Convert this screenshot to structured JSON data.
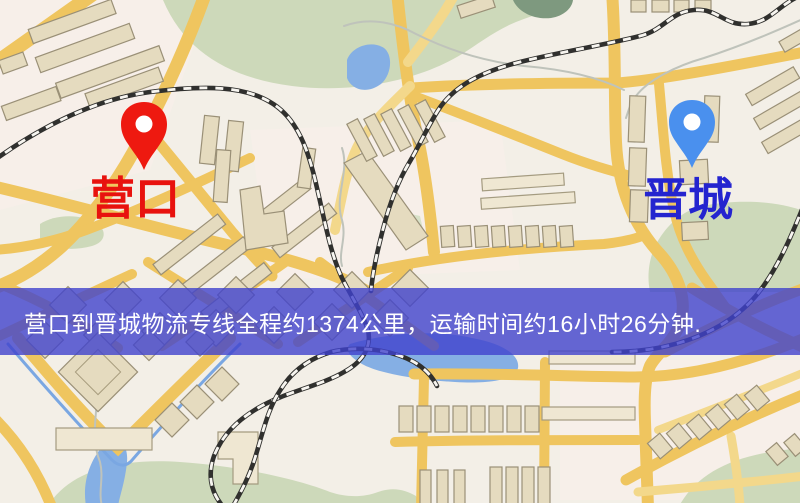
{
  "page": {
    "type": "logistics-route-map-image",
    "width_px": 800,
    "height_px": 503
  },
  "banner": {
    "text": "营口到晋城物流专线全程约1374公里，运输时间约16小时26分钟.",
    "text_color": "#ffffff",
    "background_color": "#4042cd",
    "route": {
      "origin": "营口",
      "destination": "晋城",
      "service": "物流专线",
      "distance_text": "约1374公里",
      "duration_text": "约16小时26分钟"
    }
  },
  "markers": {
    "origin": {
      "label": "营口",
      "label_color": "#e8120e",
      "pin_color": "#ee1910",
      "pin_icon": "red-map-pin-icon"
    },
    "destination": {
      "label": "晋城",
      "label_color": "#2424cf",
      "pin_color": "#4a90ee",
      "pin_icon": "blue-map-pin-icon"
    }
  },
  "map": {
    "style": "street-map",
    "colors": {
      "background": "#f3efe7",
      "road": "#efc55f",
      "building": "#e5dbbf",
      "park": "#cdd9ba",
      "water": "#85afe4",
      "railway": "#30302e"
    }
  }
}
